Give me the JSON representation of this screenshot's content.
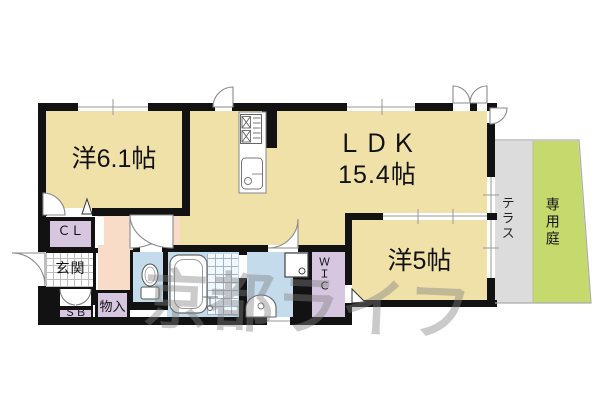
{
  "floorplan": {
    "rooms": {
      "western_room_1": {
        "label": "洋6.1帖"
      },
      "ldk": {
        "name": "ＬＤＫ",
        "size": "15.4帖"
      },
      "western_room_2": {
        "label": "洋5帖"
      },
      "closet": {
        "label": "ＣＬ"
      },
      "entrance": {
        "label": "玄関"
      },
      "shoe_box": {
        "label": "ＳＢ"
      },
      "storage": {
        "label": "物入"
      },
      "walk_in_closet": {
        "label": "ＷＩＣ"
      },
      "terrace": {
        "label": "テラス"
      },
      "private_garden": {
        "label": "専用庭"
      }
    },
    "fixtures": [
      "kitchen-stove",
      "kitchen-sink",
      "bathtub",
      "shower-tiles",
      "toilet",
      "washing-machine",
      "washbasin",
      "shoe-cabinet-doors"
    ],
    "watermark": {
      "text": "京都ライフ"
    },
    "colors": {
      "room_beige": "#f0e1a9",
      "hallway_pink": "#f8dcc8",
      "closet_lavender": "#d6c6e0",
      "wet_area_blue": "#c3dbeb",
      "terrace_gray": "#dcdcdc",
      "garden_green": "#c6d96d",
      "wall_black": "#121212"
    }
  }
}
